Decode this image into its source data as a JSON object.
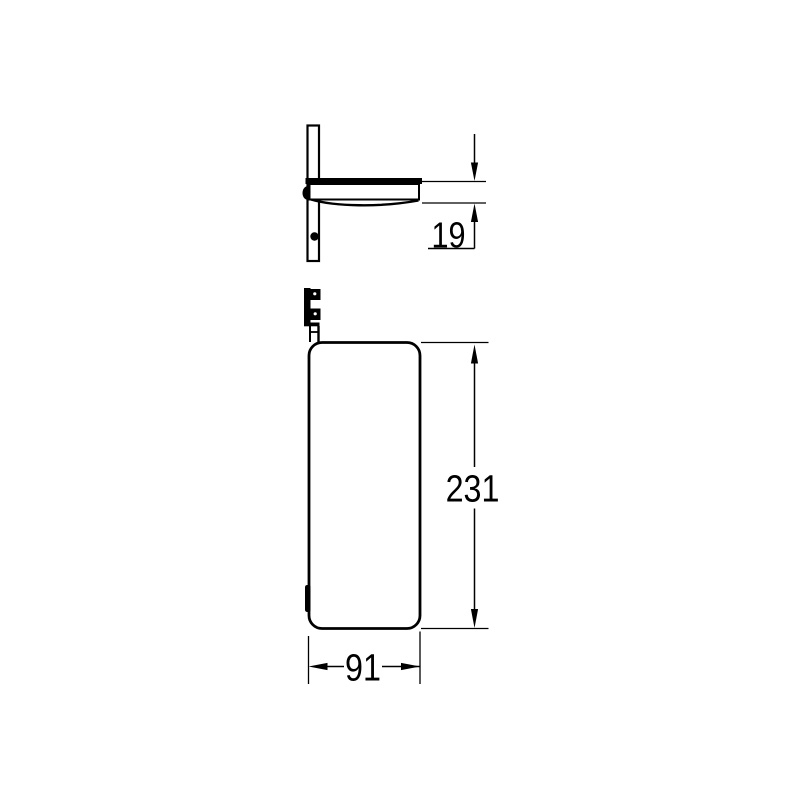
{
  "page": {
    "background_color": "#ffffff",
    "line_color": "#000000"
  },
  "drawing": {
    "type": "technical dimension drawing, two orthographic views of a wall-mounted shelf",
    "side_view": {
      "depth_dimension": "19"
    },
    "front_view": {
      "height_dimension": "231",
      "width_dimension": "91"
    }
  }
}
